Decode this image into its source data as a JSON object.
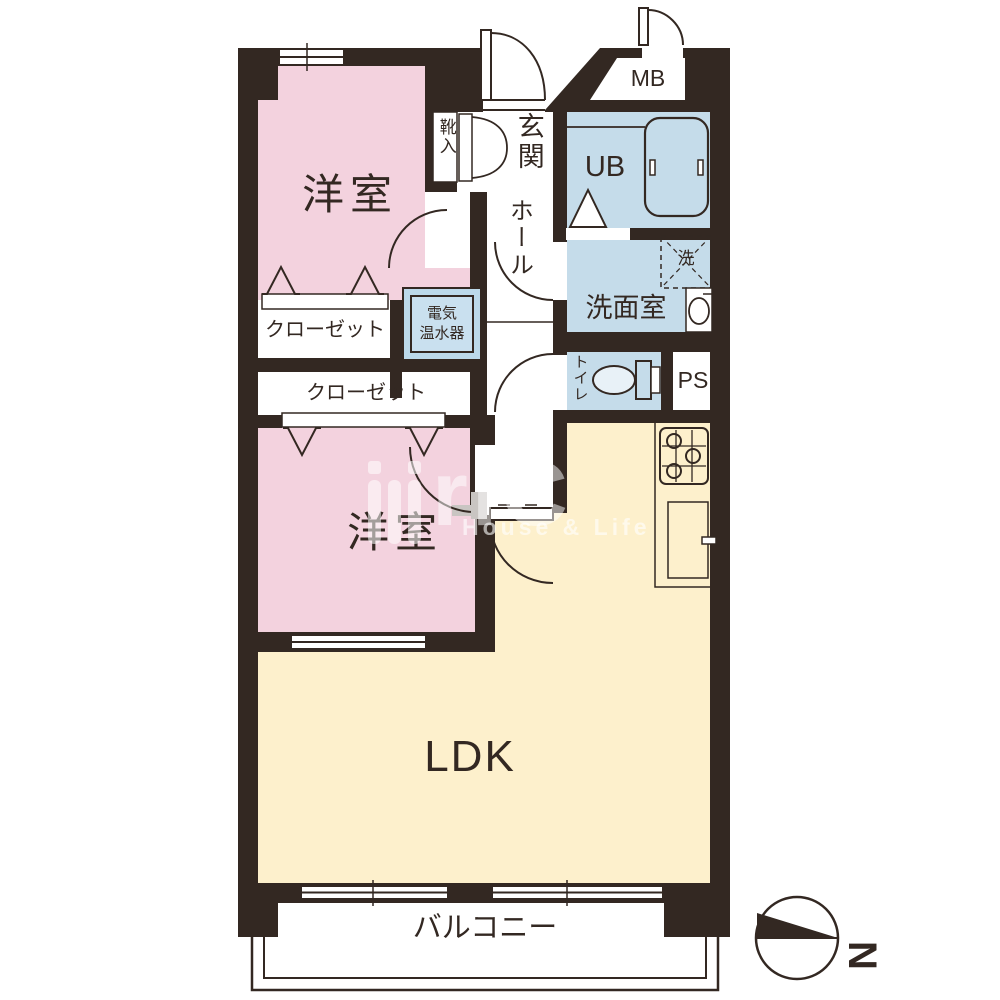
{
  "rooms": {
    "western_room_1": {
      "label": "洋室"
    },
    "western_room_2": {
      "label": "洋室"
    },
    "ldk": {
      "label": "LDK"
    },
    "balcony": {
      "label": "バルコニー"
    },
    "entrance": {
      "label": "玄関"
    },
    "hall": {
      "label": "ホール"
    },
    "shoe_cabinet": {
      "label": "靴入"
    },
    "unit_bath": {
      "label": "UB"
    },
    "washroom": {
      "label": "洗面室"
    },
    "laundry_space": {
      "label": "洗"
    },
    "toilet": {
      "label": "トイレ"
    },
    "closet_1": {
      "label": "クローゼット"
    },
    "closet_2": {
      "label": "クローゼット"
    },
    "meter_box": {
      "label": "MB"
    },
    "pipe_space": {
      "label": "PS"
    },
    "water_heater": {
      "label_line1": "電気",
      "label_line2": "温水器"
    }
  },
  "compass": {
    "north_label": "N"
  },
  "watermark": {
    "logo_text": "riC",
    "tagline": "House & Life"
  },
  "colors": {
    "wall": "#332822",
    "room_pink": "#f3d2de",
    "wet_area_blue": "#c5dcea",
    "ldk_cream": "#fdf0cc",
    "heater_blue": "#bcd9ea"
  }
}
